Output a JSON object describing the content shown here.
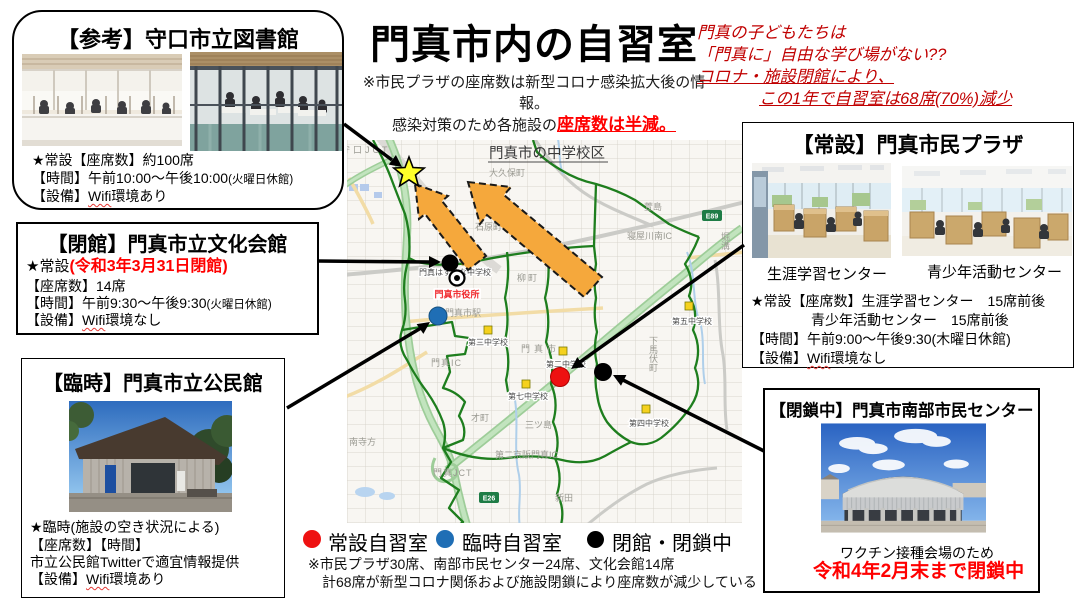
{
  "page": {
    "title": "門真市内の自習室"
  },
  "subnote": {
    "line1": "※市民プラザの座席数は新型コロナ感染拡大後の情報。",
    "line2_black": "感染対策のため各施設の",
    "line2_red": "座席数は半減。"
  },
  "headline": {
    "line1": "門真の子どもたちは",
    "line2": "「門真に」自由な学び場がない??",
    "line3": "コロナ・施設閉館により、",
    "line4": "この1年で自習室は68席(70%)減少",
    "color": "#c00000"
  },
  "boxes": {
    "library": {
      "title": "【参考】守口市立図書館",
      "seats": "★常設【座席数】約100席",
      "hours": "【時間】午前10:00〜午後10:00",
      "hours_note": "(火曜日休館)",
      "equip_prefix": "【設備】",
      "wifi": "Wifi",
      "equip_suffix": "環境あり"
    },
    "bunka": {
      "title": "【閉館】門真市立文化会館",
      "status_black": "★常設",
      "status_red": "(令和3年3月31日閉館)",
      "seats": "【座席数】14席",
      "hours": "【時間】午前9:30〜午後9:30",
      "hours_note": "(火曜日休館)",
      "equip_prefix": "【設備】",
      "wifi": "Wifi",
      "equip_suffix": "環境なし"
    },
    "kominkan": {
      "title": "【臨時】門真市立公民館",
      "status": "★臨時(施設の空き状況による)",
      "seats_time": "【座席数】【時間】",
      "twitter": "市立公民館Twitterで適宜情報提供",
      "equip_prefix": "【設備】",
      "wifi": "Wifi",
      "equip_suffix": "環境あり"
    },
    "plaza": {
      "title": "【常設】門真市民プラザ",
      "caption_left": "生涯学習センター",
      "caption_right": "青少年活動センター",
      "seats1": "★常設【座席数】生涯学習センター　15席前後",
      "seats2": "青少年活動センター　15席前後",
      "hours": "【時間】午前9:00〜午後9:30(木曜日休館)",
      "equip_prefix": "【設備】",
      "wifi": "Wifi",
      "equip_suffix": "環境なし"
    },
    "nanbu": {
      "title": "【閉鎖中】門真市南部市民センター",
      "reason": "ワクチン接種会場のため",
      "closed_red": "令和4年2月末まで閉鎖中"
    }
  },
  "map": {
    "title": "門真市の中学校区",
    "city_hall": "門真市役所",
    "station": "門真市駅",
    "labels": {
      "moriguchi_jct": "守口JCT",
      "okubo": "大久保町",
      "ishihara": "石原町",
      "yanagi": "柳町",
      "kayashima": "萱島",
      "neyagawa_ic": "寝屋川南IC",
      "horizo": "堀溝",
      "shimomabushi": "下馬伏町",
      "kadoma_city": "門真市",
      "kadoma_ic": "門真IC",
      "sai": "才町",
      "mitsushima": "三ツ島",
      "minamiterakata": "南寺方",
      "kadoma_jct": "門真JCT",
      "keihan_ic": "第二京阪門真IC",
      "shinden": "新田",
      "e26": "E26",
      "e89": "E89"
    },
    "schools": {
      "hasuhana": "門真はすはな中学校",
      "dai3": "第三中学校",
      "dai2": "第二中学校",
      "dai7": "第七中学校",
      "dai5": "第五中学校",
      "dai4": "第四中学校"
    }
  },
  "legend": {
    "permanent": "常設自習室",
    "temporary": "臨時自習室",
    "closed": "閉館・閉鎖中",
    "colors": {
      "permanent": "#ee1111",
      "temporary": "#1f6eb5",
      "closed": "#000000"
    }
  },
  "footnote": {
    "line1": "※市民プラザ30席、南部市民センター24席、文化会館14席",
    "line2": "　計68席が新型コロナ関係および施設閉鎖により座席数が減少している"
  }
}
